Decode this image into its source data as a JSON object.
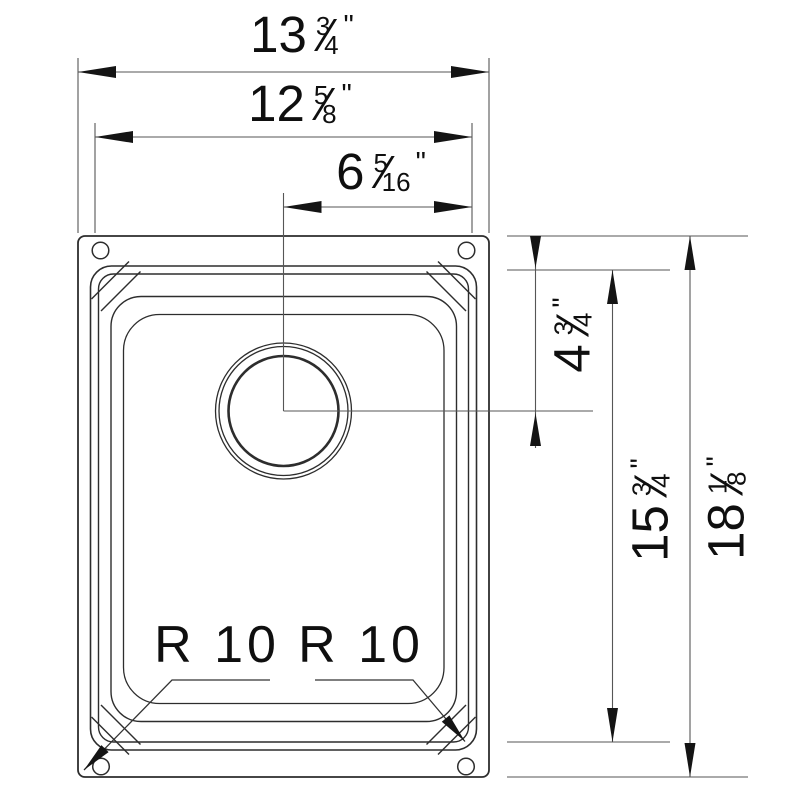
{
  "drawing": {
    "type": "sink-top-view-dimension-drawing",
    "dimensions": {
      "overall_width": {
        "whole": "13",
        "num": "3",
        "den": "4",
        "unit": "\""
      },
      "opening_width": {
        "whole": "12",
        "num": "5",
        "den": "8",
        "unit": "\""
      },
      "drain_offset": {
        "whole": "6",
        "num": "5",
        "den": "16",
        "unit": "\""
      },
      "drain_depth": {
        "whole": "4",
        "num": "3",
        "den": "4",
        "unit": "\""
      },
      "opening_height": {
        "whole": "15",
        "num": "3",
        "den": "4",
        "unit": "\""
      },
      "overall_height": {
        "whole": "18",
        "num": "1",
        "den": "8",
        "unit": "\""
      }
    },
    "radius_labels": {
      "left": "R 10",
      "right": "R 10"
    },
    "colors": {
      "outline": "#2d2d2d",
      "dim_line": "#565656",
      "arrow": "#141414",
      "text": "#0f0f0f",
      "background": "#ffffff"
    }
  }
}
